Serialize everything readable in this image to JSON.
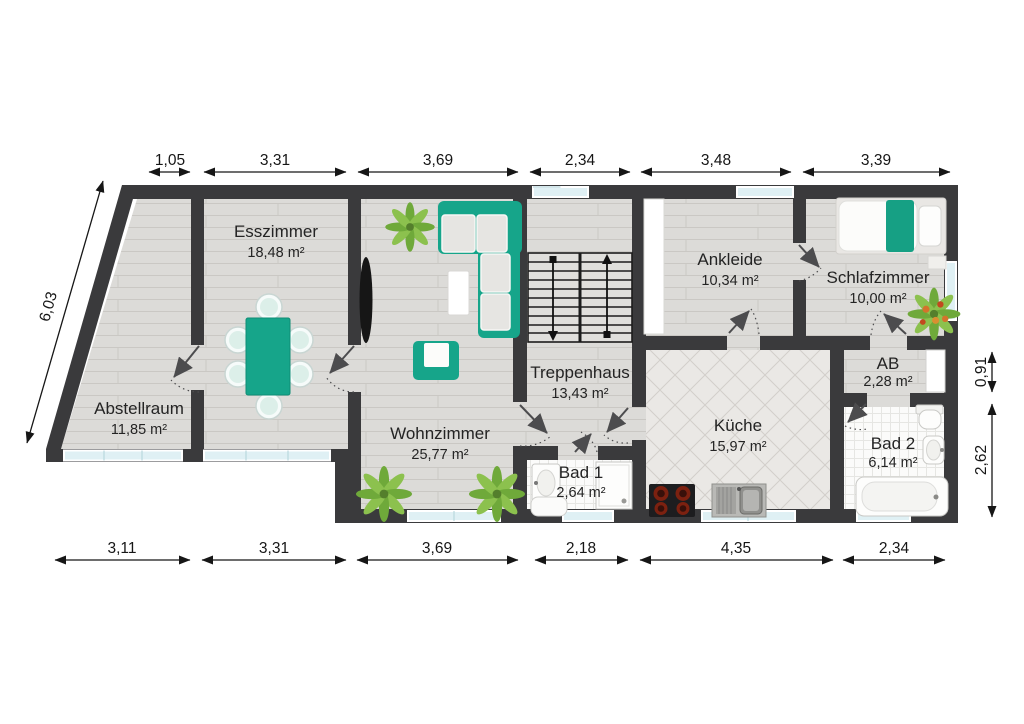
{
  "plan": {
    "rooms": [
      {
        "id": "esszimmer",
        "name": "Esszimmer",
        "area": "18,48 m²"
      },
      {
        "id": "abstellraum",
        "name": "Abstellraum",
        "area": "11,85 m²"
      },
      {
        "id": "wohnzimmer",
        "name": "Wohnzimmer",
        "area": "25,77 m²"
      },
      {
        "id": "treppenhaus",
        "name": "Treppenhaus",
        "area": "13,43 m²"
      },
      {
        "id": "bad1",
        "name": "Bad 1",
        "area": "2,64 m²"
      },
      {
        "id": "kueche",
        "name": "Küche",
        "area": "15,97 m²"
      },
      {
        "id": "ankleide",
        "name": "Ankleide",
        "area": "10,34 m²"
      },
      {
        "id": "schlafzimmer",
        "name": "Schlafzimmer",
        "area": "10,00 m²"
      },
      {
        "id": "ab",
        "name": "AB",
        "area": "2,28 m²"
      },
      {
        "id": "bad2",
        "name": "Bad 2",
        "area": "6,14 m²"
      }
    ],
    "dimensions": {
      "top": [
        "1,05",
        "3,31",
        "3,69",
        "2,34",
        "3,48",
        "3,39"
      ],
      "bottom": [
        "3,11",
        "3,31",
        "3,69",
        "2,18",
        "4,35",
        "2,34"
      ],
      "left": [
        "6,03"
      ],
      "right": [
        "0,91",
        "2,62"
      ]
    },
    "colors": {
      "wall": "#3a3a3c",
      "accent": "#16a58a",
      "plant": "#79b13f",
      "window": "#dff0f4"
    }
  }
}
